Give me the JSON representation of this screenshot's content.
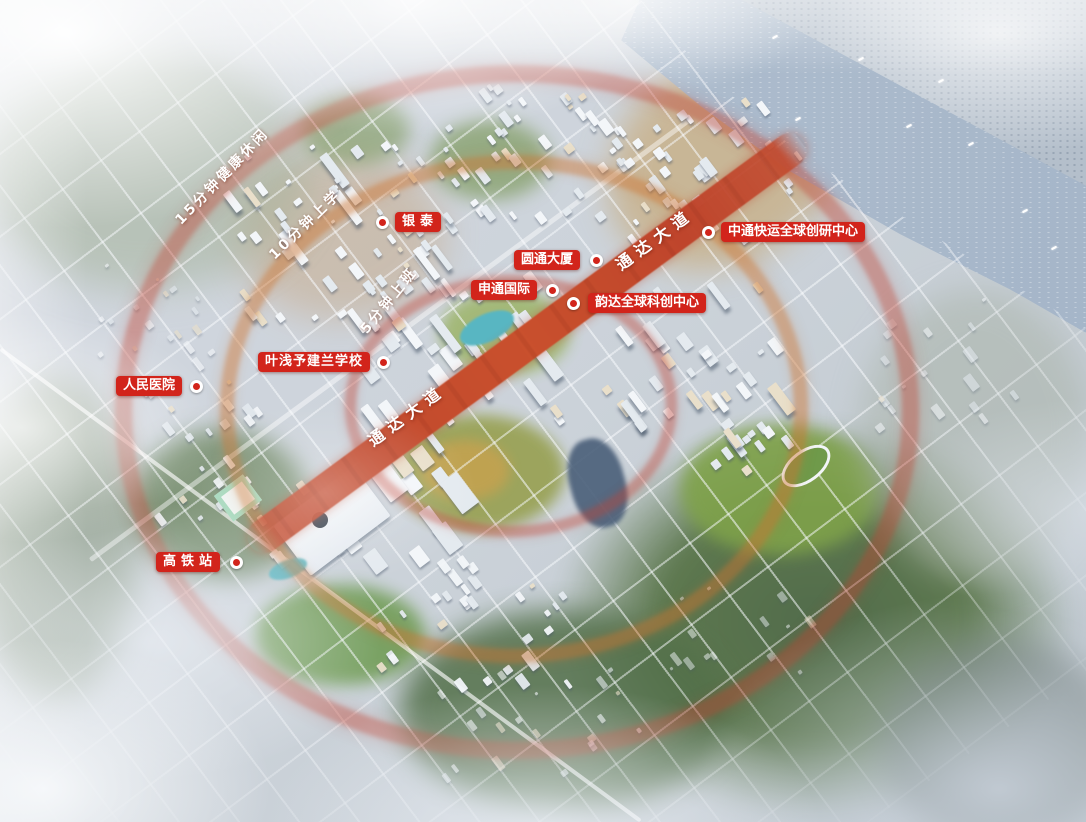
{
  "map": {
    "road_label": "通达大道",
    "rings": {
      "inner_label": "5分钟上班",
      "middle_label": "10分钟上学",
      "outer_label": "15分钟健康休闲"
    },
    "markers": [
      {
        "label": "银泰"
      },
      {
        "label": "圆通大厦"
      },
      {
        "label": "中通快运全球创研中心"
      },
      {
        "label": "申通国际"
      },
      {
        "label": "韵达全球科创中心"
      },
      {
        "label": "叶浅予建兰学校"
      },
      {
        "label": "人民医院"
      },
      {
        "label": "高铁站"
      }
    ],
    "colors": {
      "marker_red": "#d2241b",
      "road_red": "#c24a2e",
      "ring_red": "#c14232",
      "ring_amber": "#cc7330",
      "water_blue": "#adbccd"
    }
  }
}
